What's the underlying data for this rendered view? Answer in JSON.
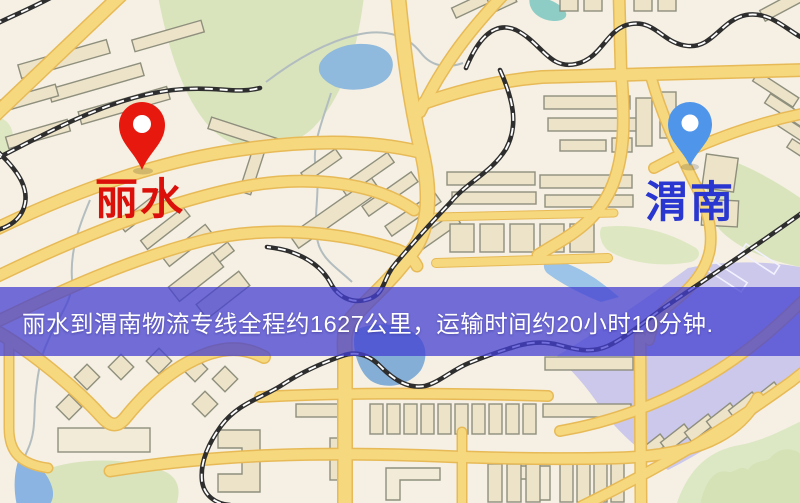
{
  "route": {
    "origin": "丽水",
    "destination": "渭南",
    "distance_text": "约1627公里",
    "duration_text": "约20小时10分钟"
  },
  "banner": {
    "text": "丽水到渭南物流专线全程约1627公里，运输时间约20小时10分钟.",
    "background_color": "#4440d2",
    "text_color": "#ffffff"
  },
  "markers": {
    "origin": {
      "label": "丽水",
      "pin_color": "#e7190f",
      "label_color": "#dc100a"
    },
    "destination": {
      "label": "渭南",
      "pin_color": "#4f95e9",
      "label_color": "#2936cf"
    }
  },
  "map_colors": {
    "background": "#f5f0e3",
    "road_fill": "#f6d87e",
    "road_casing": "#e7ba57",
    "park_green": "#d9e4bd",
    "water_blue": "#8fb9dd",
    "railway_black": "#2e2e2e",
    "building_tan": "#ece3c9",
    "lavender_district": "#c8c5ec"
  }
}
